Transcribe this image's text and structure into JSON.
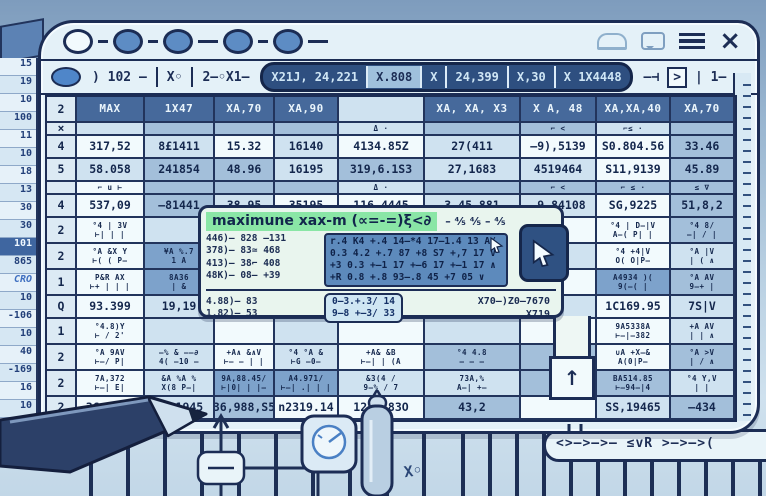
{
  "colors": {
    "accent_green": "#8ae6a6",
    "header_blue": "#46699b",
    "navy": "#1c2d55",
    "window_bg": "#e4f1f8",
    "blue_block": "#5d8abc",
    "highlight_cell": "#7da2cb",
    "dot_blue": "#5d8cc4"
  },
  "titlebar": {
    "close_glyph": "×",
    "icon_names": [
      "cloud-icon",
      "chat-bubble-icon",
      "menu-icon",
      "close-icon"
    ]
  },
  "formula_bar": {
    "left_items": [
      ") 102 –",
      "X◦",
      "2–◦X1–"
    ],
    "pill_segments": [
      {
        "t": "X21J, 24,221",
        "style": "dark"
      },
      {
        "t": "X.808",
        "style": "light"
      },
      {
        "t": "X",
        "style": "dark"
      },
      {
        "t": "24,399",
        "style": "dark"
      },
      {
        "t": "X,30",
        "style": "dark"
      },
      {
        "t": "X 1X4448",
        "style": "dark"
      }
    ],
    "right_items": [
      "–⊣",
      ">",
      "| 1–"
    ]
  },
  "backdrop": {
    "row_numbers": [
      {
        "t": "15"
      },
      {
        "t": "19"
      },
      {
        "t": "10"
      },
      {
        "t": "100"
      },
      {
        "t": "11"
      },
      {
        "t": "10"
      },
      {
        "t": "18"
      },
      {
        "t": "13"
      },
      {
        "t": "30"
      },
      {
        "t": "30"
      },
      {
        "t": "101",
        "hl": true
      },
      {
        "t": "865"
      },
      {
        "t": "CRO",
        "accent": true
      },
      {
        "t": "10"
      },
      {
        "t": "-106"
      },
      {
        "t": "10"
      },
      {
        "t": "40"
      },
      {
        "t": "-169"
      },
      {
        "t": "16"
      },
      {
        "t": "10"
      },
      {
        "t": "70"
      },
      {
        "t": "18"
      }
    ]
  },
  "grid": {
    "gutter_header": "2",
    "headers": [
      {
        "t": "MAX"
      },
      {
        "t": "1X47"
      },
      {
        "t": "XA,70"
      },
      {
        "t": "XA,90"
      },
      {
        "t": ""
      },
      {
        "t": "XA, XA, X3"
      },
      {
        "t": "X A, 48"
      },
      {
        "t": "XA,XA,40"
      },
      {
        "t": "XA,70"
      }
    ],
    "rows": [
      {
        "kind": "thin",
        "g": "×",
        "cells": [
          {
            "t": "",
            "s": 1
          },
          {
            "t": "",
            "s": 2
          },
          {
            "t": "",
            "s": 2
          },
          {
            "t": "",
            "s": 2
          },
          {
            "t": "Δ ·",
            "s": 1
          },
          {
            "t": "",
            "s": 2
          },
          {
            "t": "⌐ <",
            "s": 2
          },
          {
            "t": "⌐≤ ·",
            "s": 1
          },
          {
            "t": "",
            "s": 2
          }
        ]
      },
      {
        "kind": "num",
        "g": "4",
        "cells": [
          {
            "t": "317,52",
            "s": 0
          },
          {
            "t": "8£1411",
            "s": 1
          },
          {
            "t": "15.32",
            "s": 0
          },
          {
            "t": "16140",
            "s": 1
          },
          {
            "t": "4134.85Z",
            "s": 0
          },
          {
            "t": "27(411",
            "s": 1
          },
          {
            "t": "–9),5139",
            "s": 0
          },
          {
            "t": "S0.804.56",
            "s": 0
          },
          {
            "t": "33.46",
            "s": 2
          }
        ]
      },
      {
        "kind": "num",
        "g": "5",
        "cells": [
          {
            "t": "58.058",
            "s": 1
          },
          {
            "t": "241854",
            "s": 2
          },
          {
            "t": "48.96",
            "s": 2
          },
          {
            "t": "16195",
            "s": 1
          },
          {
            "t": "319,6.1S3",
            "s": 2
          },
          {
            "t": "27,1683",
            "s": 1
          },
          {
            "t": "4519464",
            "s": 1
          },
          {
            "t": "S11,9139",
            "s": 0
          },
          {
            "t": "45.89",
            "s": 2
          }
        ]
      },
      {
        "kind": "thin",
        "g": "",
        "cells": [
          {
            "t": "⌐ u ⊢",
            "s": 0
          },
          {
            "t": "",
            "s": 2
          },
          {
            "t": "",
            "s": 2
          },
          {
            "t": "",
            "s": 2
          },
          {
            "t": "Δ ·",
            "s": 1
          },
          {
            "t": "",
            "s": 2
          },
          {
            "t": "⌐ <",
            "s": 2
          },
          {
            "t": "⌐ ≤ ·",
            "s": 2
          },
          {
            "t": "≤ ∇",
            "s": 2
          }
        ]
      },
      {
        "kind": "num",
        "g": "4",
        "cells": [
          {
            "t": "537,09",
            "s": 0
          },
          {
            "t": "–81441",
            "s": 2
          },
          {
            "t": "38.95",
            "s": 1
          },
          {
            "t": "35195",
            "s": 0
          },
          {
            "t": "116.4445",
            "s": 0
          },
          {
            "t": "3.45.881",
            "s": 1
          },
          {
            "t": "–9.84108",
            "s": 1
          },
          {
            "t": "SG,9225",
            "s": 0
          },
          {
            "t": "51,8,2",
            "s": 2
          }
        ]
      },
      {
        "kind": "sym",
        "g": "2",
        "cells": [
          {
            "t": "°4 | 3V\n⊢| | |",
            "s": 0
          },
          {
            "t": "",
            "s": 1
          },
          {
            "t": "",
            "s": 0
          },
          {
            "t": "",
            "s": 1
          },
          {
            "t": "",
            "s": 0
          },
          {
            "t": "",
            "s": 1
          },
          {
            "t": "",
            "s": 0
          },
          {
            "t": "°4 | D–|V\nA–( P| |",
            "s": 0
          },
          {
            "t": "°4 8/\n—| / |",
            "s": 2
          }
        ]
      },
      {
        "kind": "sym",
        "g": "2",
        "cells": [
          {
            "t": "°A &X Y\n⊢( ( P–",
            "s": 0
          },
          {
            "t": "¥A %.7\n1 A",
            "s": 4
          },
          {
            "t": "",
            "s": 1
          },
          {
            "t": "",
            "s": 0
          },
          {
            "t": "",
            "s": 1
          },
          {
            "t": "",
            "s": 0
          },
          {
            "t": "",
            "s": 1
          },
          {
            "t": "°4 +4|V\nO( O|P–",
            "s": 0
          },
          {
            "t": "°A |V\n| ( ∧",
            "s": 1
          }
        ]
      },
      {
        "kind": "sym",
        "g": "1",
        "cells": [
          {
            "t": "P&R AX\n⊢+ | | |",
            "s": 0
          },
          {
            "t": "8A36\n| &",
            "s": 4
          },
          {
            "t": "",
            "s": 0
          },
          {
            "t": "",
            "s": 1
          },
          {
            "t": "",
            "s": 0
          },
          {
            "t": "",
            "s": 1
          },
          {
            "t": "",
            "s": 0
          },
          {
            "t": "A4934 )(\n9(—( |",
            "s": 4
          },
          {
            "t": "°A AV\n9—+ |",
            "s": 2
          }
        ]
      },
      {
        "kind": "num",
        "g": "Q",
        "cells": [
          {
            "t": "93.399",
            "s": 0
          },
          {
            "t": "19,19",
            "s": 1
          },
          {
            "t": "",
            "s": 1
          },
          {
            "t": "",
            "s": 0
          },
          {
            "t": "",
            "s": 1
          },
          {
            "t": "",
            "s": 0
          },
          {
            "t": "",
            "s": 1
          },
          {
            "t": "1C169.95",
            "s": 0
          },
          {
            "t": "7S|V",
            "s": 1
          }
        ]
      },
      {
        "kind": "sym",
        "g": "1",
        "cells": [
          {
            "t": "°4.8)Y\n⊢ / 2'",
            "s": 0
          },
          {
            "t": "",
            "s": 1
          },
          {
            "t": "",
            "s": 0
          },
          {
            "t": "",
            "s": 1
          },
          {
            "t": "",
            "s": 0
          },
          {
            "t": "",
            "s": 1
          },
          {
            "t": "",
            "s": 0
          },
          {
            "t": "9A5338A\n⊢—|–382",
            "s": 0
          },
          {
            "t": "+A AV\n| | ∧",
            "s": 1
          }
        ]
      },
      {
        "kind": "sym",
        "g": "2",
        "cells": [
          {
            "t": "°A 9AV\n⊢—/ P|",
            "s": 0
          },
          {
            "t": "–% & ––∂\n4( –10 –",
            "s": 1
          },
          {
            "t": "+A∧ &∧V\n⊢— – | |",
            "s": 0
          },
          {
            "t": "°4 °A &\n⊢G –0–",
            "s": 1
          },
          {
            "t": "+A& &B\n⊢—| | (A",
            "s": 0
          },
          {
            "t": "°4 4.8\n– – –",
            "s": 2
          },
          {
            "t": "%9\nA2",
            "s": 2
          },
          {
            "t": "∪A +X–&\nA(0|P—",
            "s": 0
          },
          {
            "t": "°A >V\n| / ∧",
            "s": 2
          }
        ]
      },
      {
        "kind": "sym",
        "g": "2",
        "cells": [
          {
            "t": "7A,372\n⊢—| E|",
            "s": 0
          },
          {
            "t": "&A %A %\nX(8 P–|",
            "s": 1
          },
          {
            "t": "9A,88.45/\n⊢|0| | |–",
            "s": 4
          },
          {
            "t": "A4.971/\n⊢—| .| | |",
            "s": 4
          },
          {
            "t": "&3(4 /\n9–% / 7",
            "s": 1
          },
          {
            "t": "73A,%\nA–| +–",
            "s": 1
          },
          {
            "t": ")S8\nX–",
            "s": 2
          },
          {
            "t": "BA514.85\n⊢—94–|4",
            "s": 2
          },
          {
            "t": "°4 Y,V\n| |",
            "s": 1
          }
        ]
      },
      {
        "kind": "num",
        "g": "2",
        "cells": [
          {
            "t": "36,9122",
            "s": 0
          },
          {
            "t": "1,91945",
            "s": 1
          },
          {
            "t": "36,988,S5",
            "s": 2
          },
          {
            "t": "n2319.14",
            "s": 0
          },
          {
            "t": "1243.83O",
            "s": 0
          },
          {
            "t": "43,2",
            "s": 2
          },
          {
            "t": "",
            "s": 0
          },
          {
            "t": "SS,19465",
            "s": 1
          },
          {
            "t": "–434",
            "s": 2
          }
        ]
      }
    ]
  },
  "tooltip": {
    "title": "maximune xax-m (∝=-=)ξ<∂",
    "title_tail": "– ⅘ ⅘ – ⅘",
    "left_lines": [
      "446)– 828 –131",
      "378)– 83≃ 468",
      "413)– 38⌐ 408",
      "48K)– 08– +39"
    ],
    "blue_lines": [
      "r.4 K4 +.4 14–*4 17–1.4 13 A/",
      "0.3 4.2 +.7 87 +8 S7 +,7 17 V",
      "+3 0.3 +–1 17 +–6 17 +–1 17 ∧",
      "+R 0.8 +.8 93–.8 45 +7 05 ∨"
    ],
    "bottom_left_lines": [
      "4.88)– 83",
      "1.82)– 53"
    ],
    "boxed_lines": [
      "0–3.+.3/ 14",
      "9–8 +–3/ 33"
    ],
    "right_lines": [
      "X70–)Z0–7670",
      "X719"
    ]
  },
  "callout": {
    "tail_arrow": "↑"
  },
  "scene": {
    "arrow_strip": "<>—>—>— ≤vR >—>—>(",
    "xo_label": "X◦",
    "icon_names": [
      "pencil-icon",
      "minus-node-icon",
      "gauge-icon",
      "marker-pen-icon"
    ]
  }
}
